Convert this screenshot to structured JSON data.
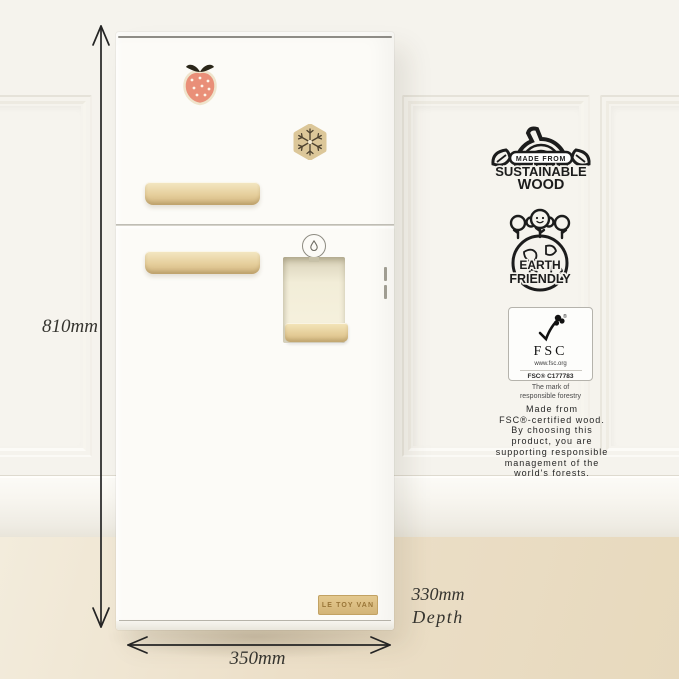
{
  "annotations": {
    "height_label": "810mm",
    "width_label": "350mm",
    "depth_value": "330mm",
    "depth_word": "Depth"
  },
  "fridge": {
    "brand_plaque": "LE TOY VAN"
  },
  "badges": {
    "sustainable_wood": {
      "arc_text": "MADE FROM",
      "word1": "SUSTAINABLE",
      "word2": "WOOD"
    },
    "earth_friendly": {
      "word1": "EARTH",
      "word2": "FRIENDLY"
    },
    "fsc": {
      "name": "FSC",
      "url": "www.fsc.org",
      "license": "FSC® C177783",
      "tagline": "The mark of responsible forestry"
    },
    "description_lines": [
      "Made from",
      "FSC®-certified wood.",
      "By choosing this",
      "product, you are",
      "supporting responsible",
      "management of the",
      "world's forests."
    ]
  },
  "icons": {
    "magnet_top": "strawberry-magnet",
    "magnet_bottom": "snowflake-magnet",
    "dispenser_icon": "water-drop-icon"
  },
  "colors": {
    "wall": "#f5f3ed",
    "floor": "#ebdfc8",
    "fridge_body": "#fcfbf7",
    "wood": "#e3cc97",
    "strawberry": "#e98f78",
    "badge_ink": "#1c1c1c"
  }
}
